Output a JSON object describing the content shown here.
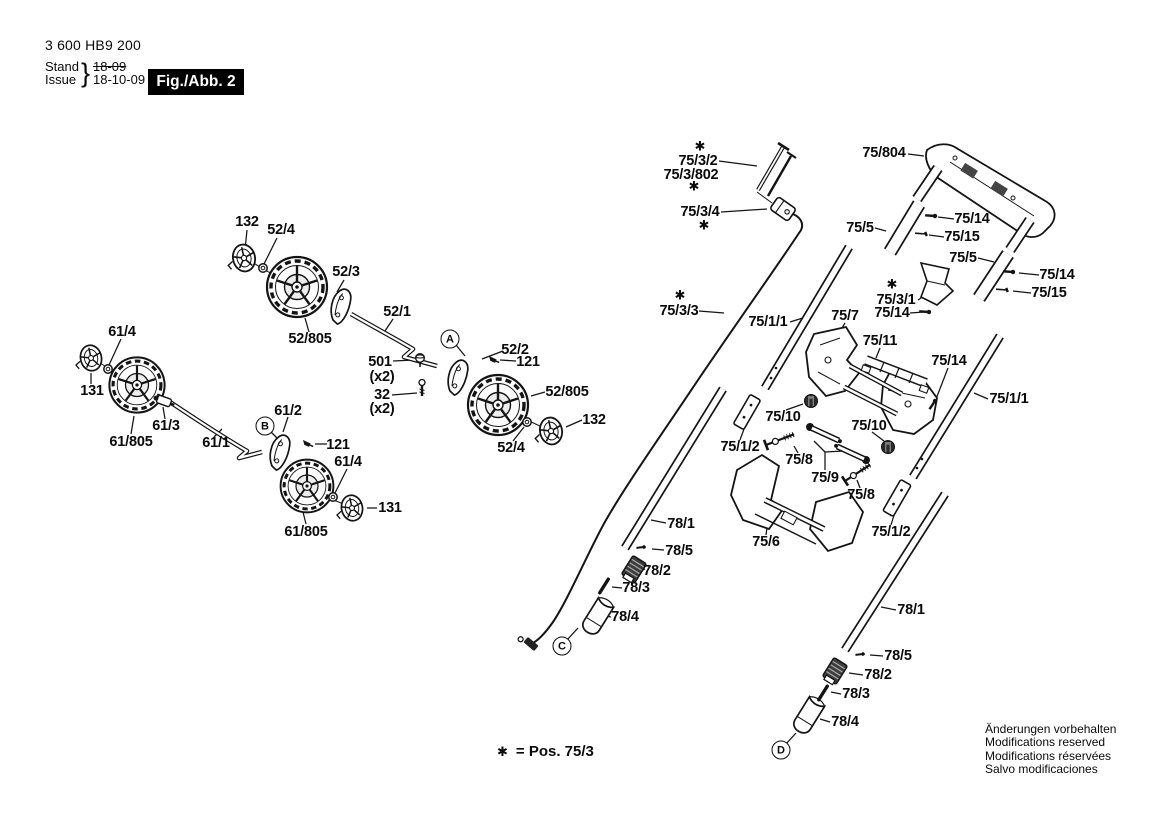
{
  "header": {
    "type_number": "3 600 HB9 200",
    "stand_label": "Stand",
    "issue_label": "Issue",
    "brace": "}",
    "old_date": "18-09",
    "new_date": "18-10-09",
    "figure_label": "Fig./Abb. 2"
  },
  "footnote": {
    "symbol": "✱",
    "text": "= Pos. 75/3"
  },
  "disclaimer": {
    "lines": [
      "Änderungen vorbehalten",
      "Modifications reserved",
      "Modifications réservées",
      "Salvo modificaciones"
    ]
  },
  "labels": [
    {
      "text": "132",
      "x": 247,
      "y": 222
    },
    {
      "text": "52/4",
      "x": 281,
      "y": 230
    },
    {
      "text": "52/3",
      "x": 346,
      "y": 272
    },
    {
      "text": "52/1",
      "x": 397,
      "y": 312
    },
    {
      "text": "52/805",
      "x": 310,
      "y": 339
    },
    {
      "text": "501",
      "x": 380,
      "y": 362
    },
    {
      "text": "(x2)",
      "x": 382,
      "y": 377
    },
    {
      "text": "32",
      "x": 382,
      "y": 395
    },
    {
      "text": "(x2)",
      "x": 382,
      "y": 409
    },
    {
      "text": "52/2",
      "x": 515,
      "y": 350
    },
    {
      "text": "121",
      "x": 528,
      "y": 362
    },
    {
      "text": "52/805",
      "x": 567,
      "y": 392
    },
    {
      "text": "132",
      "x": 594,
      "y": 420
    },
    {
      "text": "52/4",
      "x": 511,
      "y": 448
    },
    {
      "text": "61/4",
      "x": 122,
      "y": 332
    },
    {
      "text": "131",
      "x": 92,
      "y": 391
    },
    {
      "text": "61/805",
      "x": 131,
      "y": 442
    },
    {
      "text": "61/3",
      "x": 166,
      "y": 426
    },
    {
      "text": "61/1",
      "x": 216,
      "y": 443
    },
    {
      "text": "61/2",
      "x": 288,
      "y": 411
    },
    {
      "text": "121",
      "x": 338,
      "y": 445
    },
    {
      "text": "61/4",
      "x": 348,
      "y": 462
    },
    {
      "text": "131",
      "x": 390,
      "y": 508
    },
    {
      "text": "61/805",
      "x": 306,
      "y": 532
    },
    {
      "text": "75/3/2",
      "x": 698,
      "y": 161
    },
    {
      "text": "75/3/802",
      "x": 691,
      "y": 175
    },
    {
      "text": "75/3/4",
      "x": 700,
      "y": 212
    },
    {
      "text": "75/3/3",
      "x": 679,
      "y": 311
    },
    {
      "text": "75/1/1",
      "x": 768,
      "y": 322
    },
    {
      "text": "75/7",
      "x": 845,
      "y": 316
    },
    {
      "text": "75/11",
      "x": 880,
      "y": 341
    },
    {
      "text": "75/804",
      "x": 884,
      "y": 153
    },
    {
      "text": "75/5",
      "x": 860,
      "y": 228
    },
    {
      "text": "75/14",
      "x": 972,
      "y": 219
    },
    {
      "text": "75/15",
      "x": 962,
      "y": 237
    },
    {
      "text": "75/5",
      "x": 963,
      "y": 258
    },
    {
      "text": "75/14",
      "x": 1057,
      "y": 275
    },
    {
      "text": "75/15",
      "x": 1049,
      "y": 293
    },
    {
      "text": "75/3/1",
      "x": 896,
      "y": 300
    },
    {
      "text": "75/14",
      "x": 892,
      "y": 313
    },
    {
      "text": "75/14",
      "x": 949,
      "y": 361
    },
    {
      "text": "75/1/1",
      "x": 1009,
      "y": 399
    },
    {
      "text": "75/10",
      "x": 783,
      "y": 417
    },
    {
      "text": "75/10",
      "x": 869,
      "y": 426
    },
    {
      "text": "75/1/2",
      "x": 740,
      "y": 447
    },
    {
      "text": "75/8",
      "x": 799,
      "y": 460
    },
    {
      "text": "75/9",
      "x": 825,
      "y": 478
    },
    {
      "text": "75/8",
      "x": 861,
      "y": 495
    },
    {
      "text": "75/1/2",
      "x": 891,
      "y": 532
    },
    {
      "text": "75/6",
      "x": 766,
      "y": 542
    },
    {
      "text": "78/1",
      "x": 681,
      "y": 524
    },
    {
      "text": "78/5",
      "x": 679,
      "y": 551
    },
    {
      "text": "78/2",
      "x": 657,
      "y": 571
    },
    {
      "text": "78/3",
      "x": 636,
      "y": 588
    },
    {
      "text": "78/4",
      "x": 625,
      "y": 617
    },
    {
      "text": "78/1",
      "x": 911,
      "y": 610
    },
    {
      "text": "78/5",
      "x": 898,
      "y": 656
    },
    {
      "text": "78/2",
      "x": 878,
      "y": 675
    },
    {
      "text": "78/3",
      "x": 856,
      "y": 694
    },
    {
      "text": "78/4",
      "x": 845,
      "y": 722
    }
  ],
  "stars": [
    {
      "x": 700,
      "y": 147
    },
    {
      "x": 694,
      "y": 187
    },
    {
      "x": 704,
      "y": 226
    },
    {
      "x": 680,
      "y": 296
    },
    {
      "x": 892,
      "y": 285
    }
  ],
  "markers": [
    {
      "letter": "A",
      "x": 450,
      "y": 339
    },
    {
      "letter": "B",
      "x": 265,
      "y": 426
    },
    {
      "letter": "C",
      "x": 562,
      "y": 646
    },
    {
      "letter": "D",
      "x": 781,
      "y": 750
    }
  ]
}
